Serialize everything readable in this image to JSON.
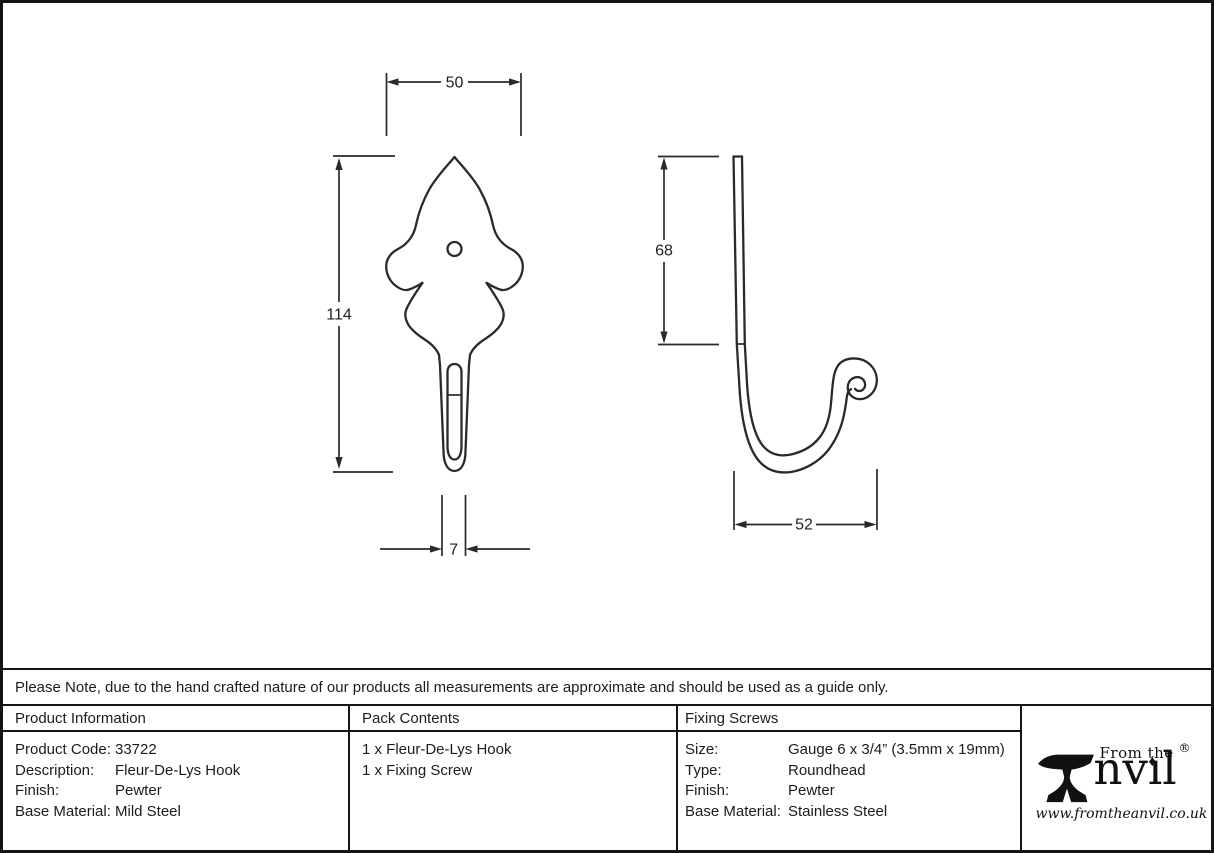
{
  "note": "Please Note, due to the hand crafted nature of our products all measurements are approximate and should be used as a guide only.",
  "drawing": {
    "front_width": "50",
    "front_height": "114",
    "front_stem_width": "7",
    "side_plate_height": "68",
    "side_hook_reach": "52"
  },
  "table": {
    "product_info": {
      "header": "Product Information",
      "rows": [
        {
          "label": "Product Code:",
          "value": "33722"
        },
        {
          "label": "Description:",
          "value": "Fleur-De-Lys Hook"
        },
        {
          "label": "Finish:",
          "value": "Pewter"
        },
        {
          "label": "Base Material:",
          "value": "Mild Steel"
        }
      ]
    },
    "pack_contents": {
      "header": "Pack Contents",
      "items": [
        "1 x Fleur-De-Lys Hook",
        "1 x Fixing Screw"
      ]
    },
    "fixing_screws": {
      "header": "Fixing Screws",
      "rows": [
        {
          "label": "Size:",
          "value": "Gauge 6 x 3/4” (3.5mm x 19mm)"
        },
        {
          "label": "Type:",
          "value": "Roundhead"
        },
        {
          "label": "Finish:",
          "value": "Pewter"
        },
        {
          "label": "Base Material:",
          "value": "Stainless Steel"
        }
      ]
    }
  },
  "logo": {
    "tagline": "From the",
    "brand_suffix": "nvıl",
    "i_dot": "♦",
    "registered": "®",
    "url": "www.fromtheanvil.co.uk"
  }
}
